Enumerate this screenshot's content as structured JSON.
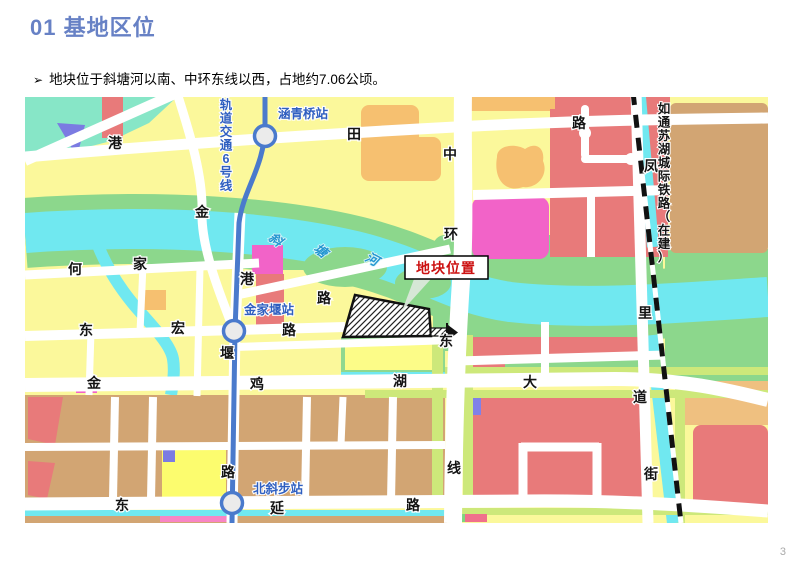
{
  "slide": {
    "title": "01 基地区位",
    "bullet_marker": "➢",
    "bullet_text": "地块位于斜塘河以南、中环东线以西，占地约7.06公顷。",
    "page_number": "3"
  },
  "map": {
    "callout_label": "地块位置",
    "metro_line_name": "轨道交通6号线",
    "railway_name": "如通苏湖城际铁路（在建）",
    "river_name": "斜塘河",
    "stations": [
      "涵青桥站",
      "金家堰站",
      "北斜步站"
    ],
    "colors": {
      "base_yellow": "#fbf89b",
      "mint": "#87e6c7",
      "green": "#8cd78c",
      "river_cyan": "#70e8f0",
      "salmon": "#e87a7a",
      "magenta": "#f263c8",
      "orange": "#f6c070",
      "tan": "#d2a573",
      "purple": "#7b7be2",
      "lime": "#cde87a",
      "bright_yellow": "#fcfc6e",
      "metro_blue": "#4a7acc",
      "station_text": "#2f5fc0",
      "river_text": "#2596d1",
      "callout_red": "#cc1111",
      "title_blue": "#6781c5"
    },
    "labels": [
      {
        "t": "港",
        "x": 90,
        "y": 51,
        "cls": "road"
      },
      {
        "t": "田",
        "x": 329,
        "y": 42,
        "cls": "road"
      },
      {
        "t": "路",
        "x": 554,
        "y": 31,
        "cls": "road"
      },
      {
        "t": "中",
        "x": 425,
        "y": 62,
        "cls": "road"
      },
      {
        "t": "环",
        "x": 426,
        "y": 142,
        "cls": "road"
      },
      {
        "t": "东",
        "x": 421,
        "y": 249,
        "cls": "road"
      },
      {
        "t": "线",
        "x": 429,
        "y": 376,
        "cls": "road"
      },
      {
        "t": "凤",
        "x": 626,
        "y": 74,
        "cls": "road"
      },
      {
        "t": "里",
        "x": 620,
        "y": 221,
        "cls": "road"
      },
      {
        "t": "街",
        "x": 626,
        "y": 382,
        "cls": "road"
      },
      {
        "t": "金",
        "x": 177,
        "y": 120,
        "cls": "road"
      },
      {
        "t": "港",
        "x": 222,
        "y": 187,
        "cls": "road"
      },
      {
        "t": "路",
        "x": 299,
        "y": 206,
        "cls": "road"
      },
      {
        "t": "何",
        "x": 50,
        "y": 177,
        "cls": "road"
      },
      {
        "t": "家",
        "x": 115,
        "y": 172,
        "cls": "road"
      },
      {
        "t": "东",
        "x": 61,
        "y": 238,
        "cls": "road"
      },
      {
        "t": "宏",
        "x": 153,
        "y": 236,
        "cls": "road"
      },
      {
        "t": "路",
        "x": 264,
        "y": 238,
        "cls": "road"
      },
      {
        "t": "堰",
        "x": 202,
        "y": 261,
        "cls": "road"
      },
      {
        "t": "金",
        "x": 69,
        "y": 291,
        "cls": "road"
      },
      {
        "t": "鸡",
        "x": 232,
        "y": 292,
        "cls": "road"
      },
      {
        "t": "湖",
        "x": 375,
        "y": 289,
        "cls": "road"
      },
      {
        "t": "大",
        "x": 505,
        "y": 290,
        "cls": "road"
      },
      {
        "t": "道",
        "x": 615,
        "y": 305,
        "cls": "road"
      },
      {
        "t": "路",
        "x": 203,
        "y": 380,
        "cls": "road"
      },
      {
        "t": "东",
        "x": 97,
        "y": 413,
        "cls": "road"
      },
      {
        "t": "延",
        "x": 252,
        "y": 416,
        "cls": "road"
      },
      {
        "t": "路",
        "x": 388,
        "y": 413,
        "cls": "road"
      },
      {
        "t": "涵青桥站",
        "x": 278,
        "y": 21,
        "cls": "station"
      },
      {
        "t": "金家堰站",
        "x": 244,
        "y": 217,
        "cls": "station"
      },
      {
        "t": "北斜步站",
        "x": 253,
        "y": 396,
        "cls": "station"
      },
      {
        "t": "斜",
        "x": 248,
        "y": 146,
        "cls": "river",
        "rot": 38
      },
      {
        "t": "塘",
        "x": 293,
        "y": 157,
        "cls": "river",
        "rot": 38
      },
      {
        "t": "河",
        "x": 345,
        "y": 166,
        "cls": "river",
        "rot": 28
      },
      {
        "t": "轨道交通6号线",
        "x": 201,
        "y": 12,
        "cls": "metro",
        "vertical": true,
        "dy": 13.5
      },
      {
        "t": "如通苏湖城际铁路（在建）",
        "x": 639,
        "y": 16,
        "cls": "rail",
        "vertical": true,
        "dy": 13.5
      },
      {
        "t": "地块位置",
        "x": 421,
        "y": 176,
        "cls": "callout"
      }
    ]
  }
}
